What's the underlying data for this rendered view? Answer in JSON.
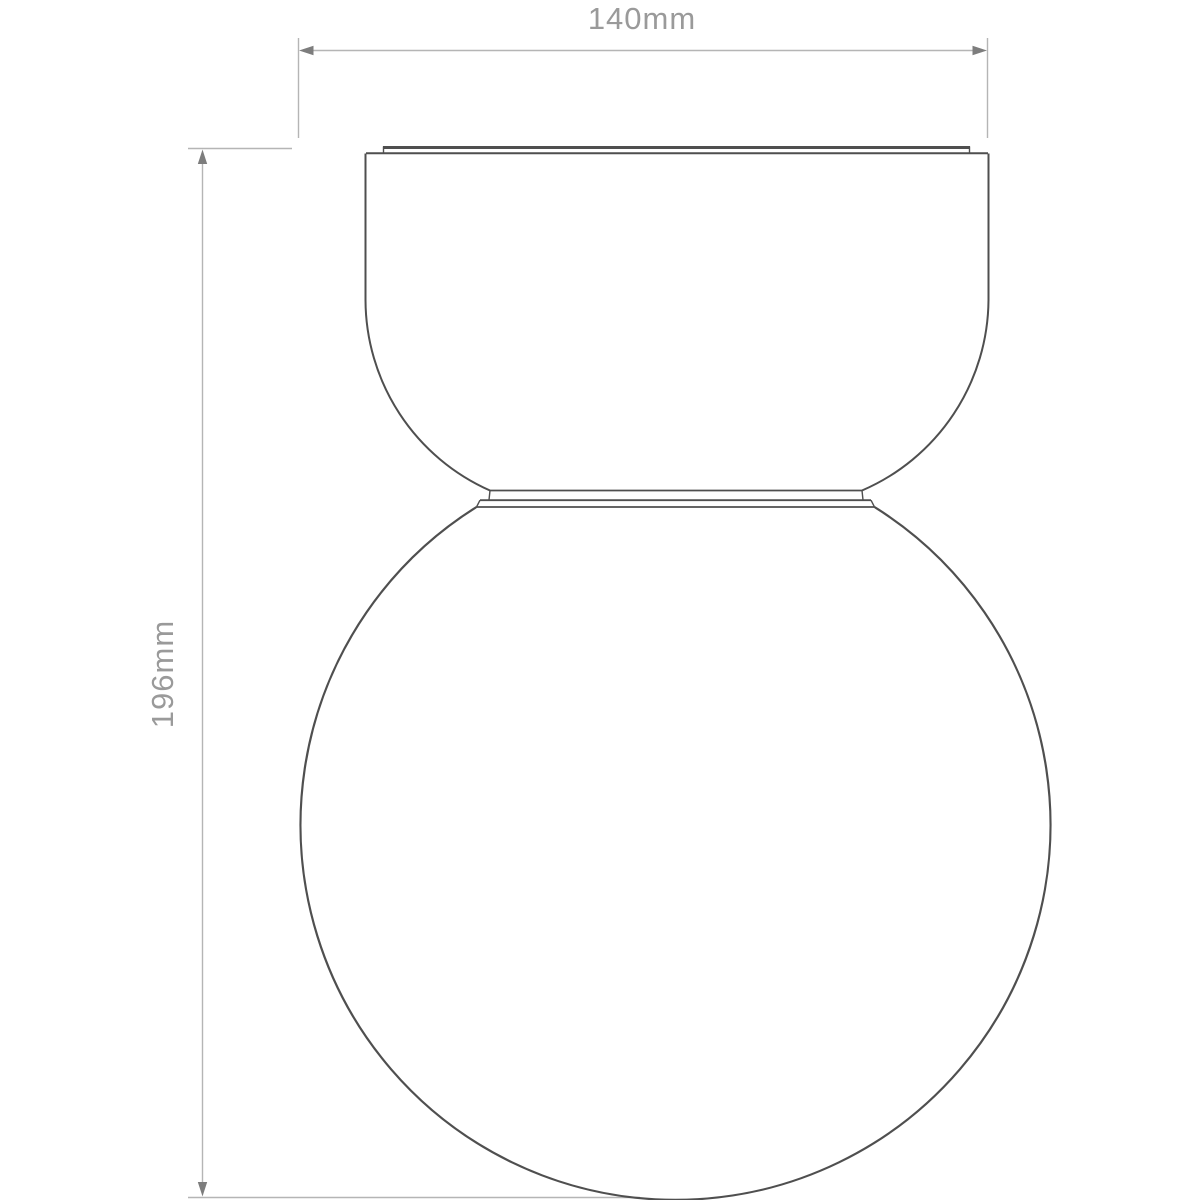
{
  "drawing": {
    "kind": "technical-dimension-diagram",
    "subject": "ceiling light fixture with dome canopy and globe diffuser",
    "dimension_width": {
      "label": "140mm"
    },
    "dimension_height": {
      "label": "196mm"
    },
    "colors": {
      "background": "#ffffff",
      "fixture_outline": "#4f4f4f",
      "dimension_line": "#b5b5b5",
      "arrowhead": "#7d7d7d",
      "label_text": "#9a9a9a"
    }
  }
}
